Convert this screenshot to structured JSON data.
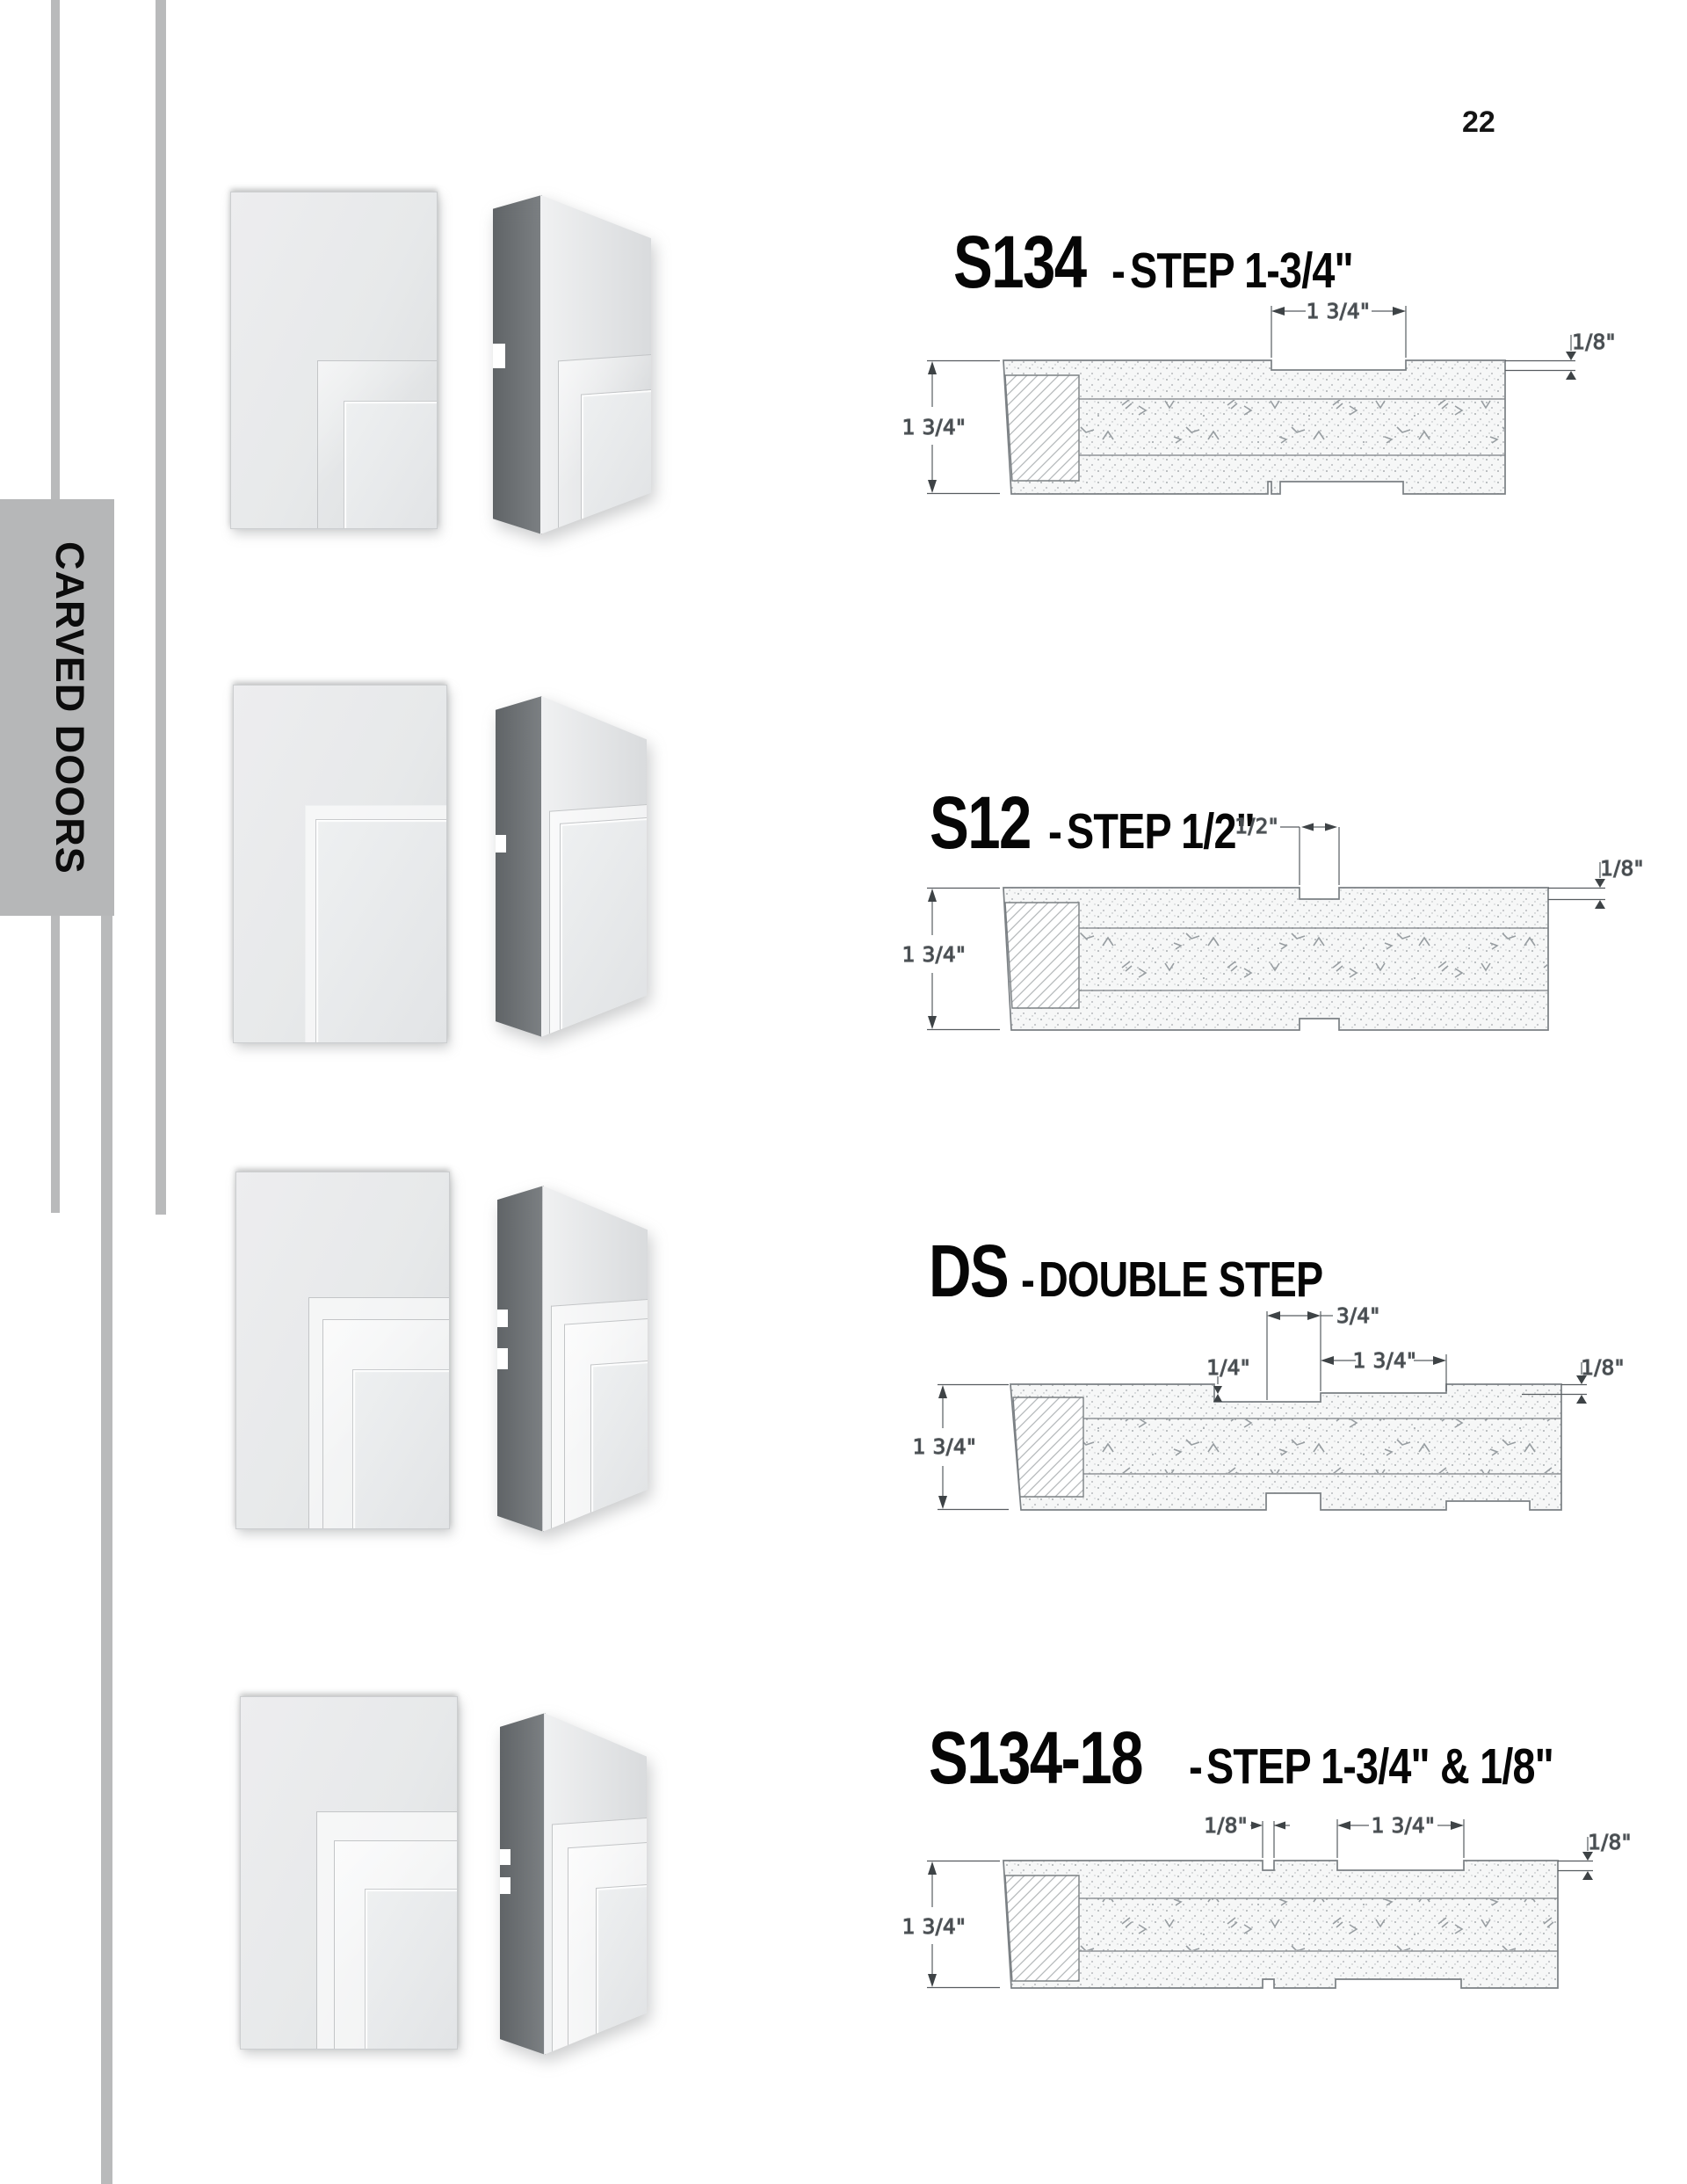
{
  "page_number": "22",
  "sidebar": {
    "label": "CARVED DOORS"
  },
  "rows": [
    {
      "code": "S134",
      "dash": "-",
      "name": "STEP 1-3/4\"",
      "dims": {
        "left": "1 3/4\"",
        "top": "1 3/4\"",
        "right": "1/8\""
      }
    },
    {
      "code": "S12",
      "dash": "-",
      "name": "STEP 1/2\"",
      "dims": {
        "left": "1 3/4\"",
        "top": "1/2\"",
        "right": "1/8\""
      }
    },
    {
      "code": "DS",
      "dash": "-",
      "name": "DOUBLE STEP",
      "dims": {
        "left": "1 3/4\"",
        "top": "3/4\"",
        "top2": "1 3/4\"",
        "depth": "1/4\"",
        "right": "1/8\""
      }
    },
    {
      "code": "S134-18",
      "dash": "-",
      "name": "STEP 1-3/4\" & 1/8\"",
      "dims": {
        "left": "1 3/4\"",
        "top": "1/8\"",
        "top2": "1 3/4\"",
        "right": "1/8\""
      }
    }
  ],
  "colors": {
    "sidebar_gray": "#b9babb",
    "line_gray": "#7b8084",
    "dim_text": "#3c4144"
  }
}
